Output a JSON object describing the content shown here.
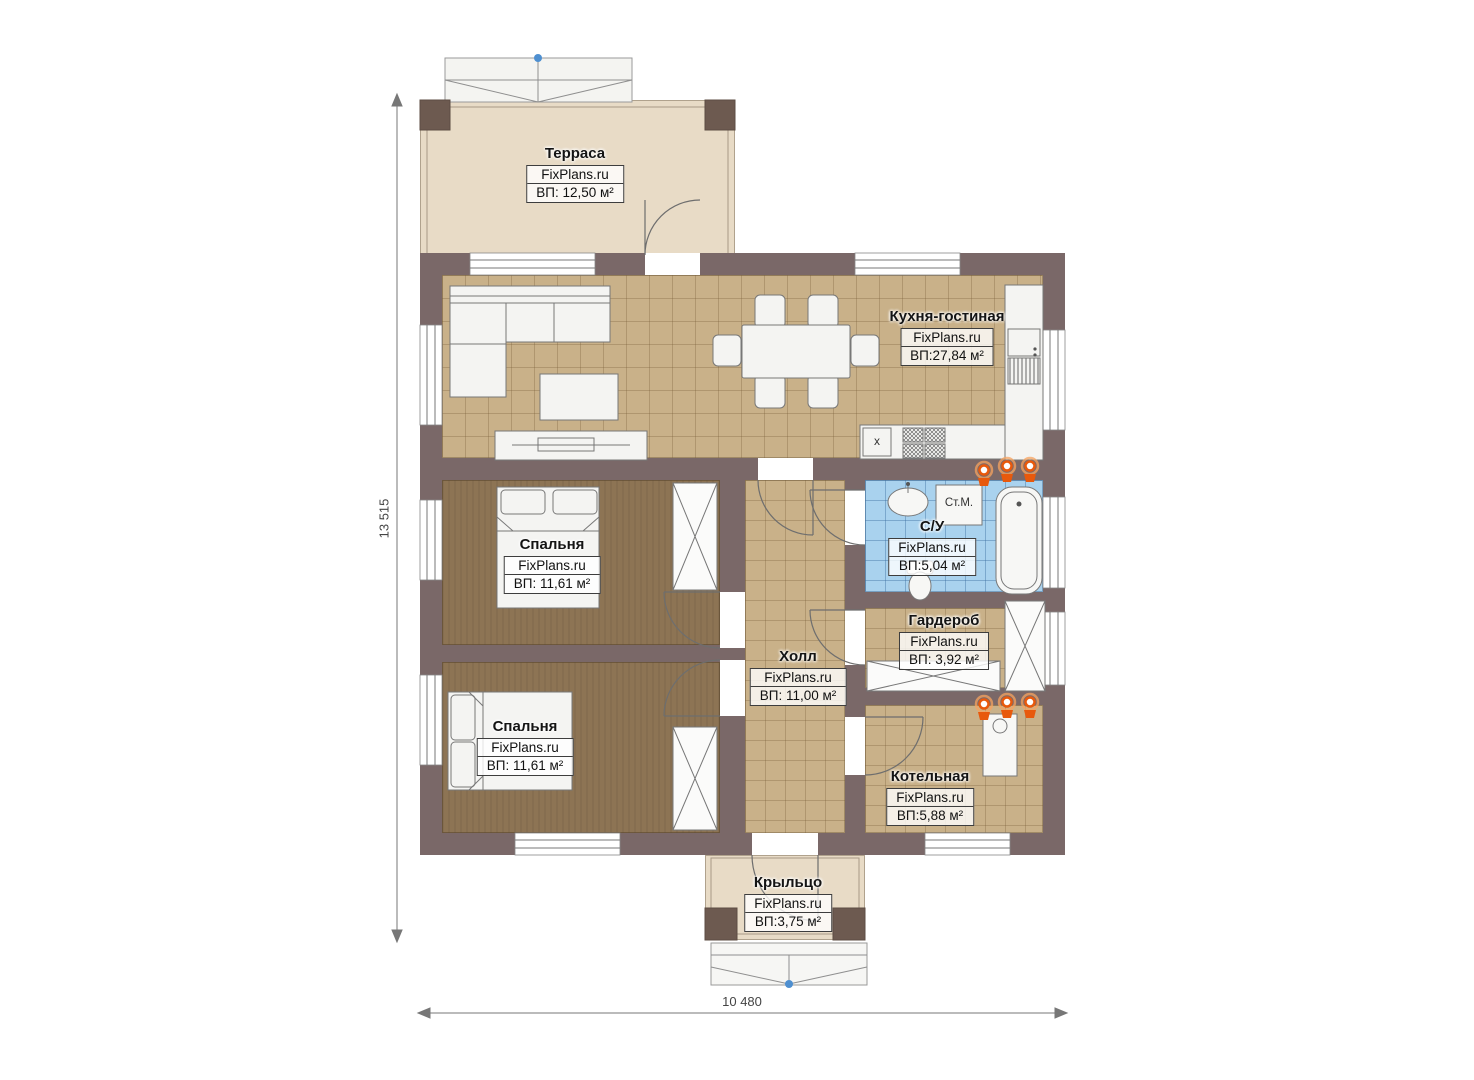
{
  "plan": {
    "brand": "FixPlans.ru",
    "dimensions": {
      "height": "13 515",
      "width": "10 480"
    },
    "rooms": [
      {
        "id": "terrace",
        "name": "Терраса",
        "brand": "FixPlans.ru",
        "area": "ВП: 12,50 м²"
      },
      {
        "id": "kitchen-living",
        "name": "Кухня-гостиная",
        "brand": "FixPlans.ru",
        "area": "ВП:27,84 м²"
      },
      {
        "id": "bedroom-1",
        "name": "Спальня",
        "brand": "FixPlans.ru",
        "area": "ВП: 11,61 м²"
      },
      {
        "id": "bedroom-2",
        "name": "Спальня",
        "brand": "FixPlans.ru",
        "area": "ВП: 11,61 м²"
      },
      {
        "id": "hall",
        "name": "Холл",
        "brand": "FixPlans.ru",
        "area": "ВП: 11,00 м²"
      },
      {
        "id": "bathroom",
        "name": "С/У",
        "brand": "FixPlans.ru",
        "area": "ВП:5,04 м²"
      },
      {
        "id": "wardrobe",
        "name": "Гардероб",
        "brand": "FixPlans.ru",
        "area": "ВП: 3,92 м²"
      },
      {
        "id": "boiler",
        "name": "Котельная",
        "brand": "FixPlans.ru",
        "area": "ВП:5,88 м²"
      },
      {
        "id": "porch",
        "name": "Крыльцо",
        "brand": "FixPlans.ru",
        "area": "ВП:3,75 м²"
      }
    ],
    "annotations": {
      "washing_machine": "Ст.М.",
      "kitchen_sink_mark": "x"
    },
    "colors": {
      "wall": "#7a6868",
      "pillar": "#6d5a50",
      "floor_tile": "#c9b189",
      "floor_bedroom": "#8d7454",
      "floor_bath": "#a9d2ee",
      "terrace_floor": "#e8dbc6",
      "radiator": "#e8590c",
      "marker_blue": "#4e8fd0"
    }
  }
}
